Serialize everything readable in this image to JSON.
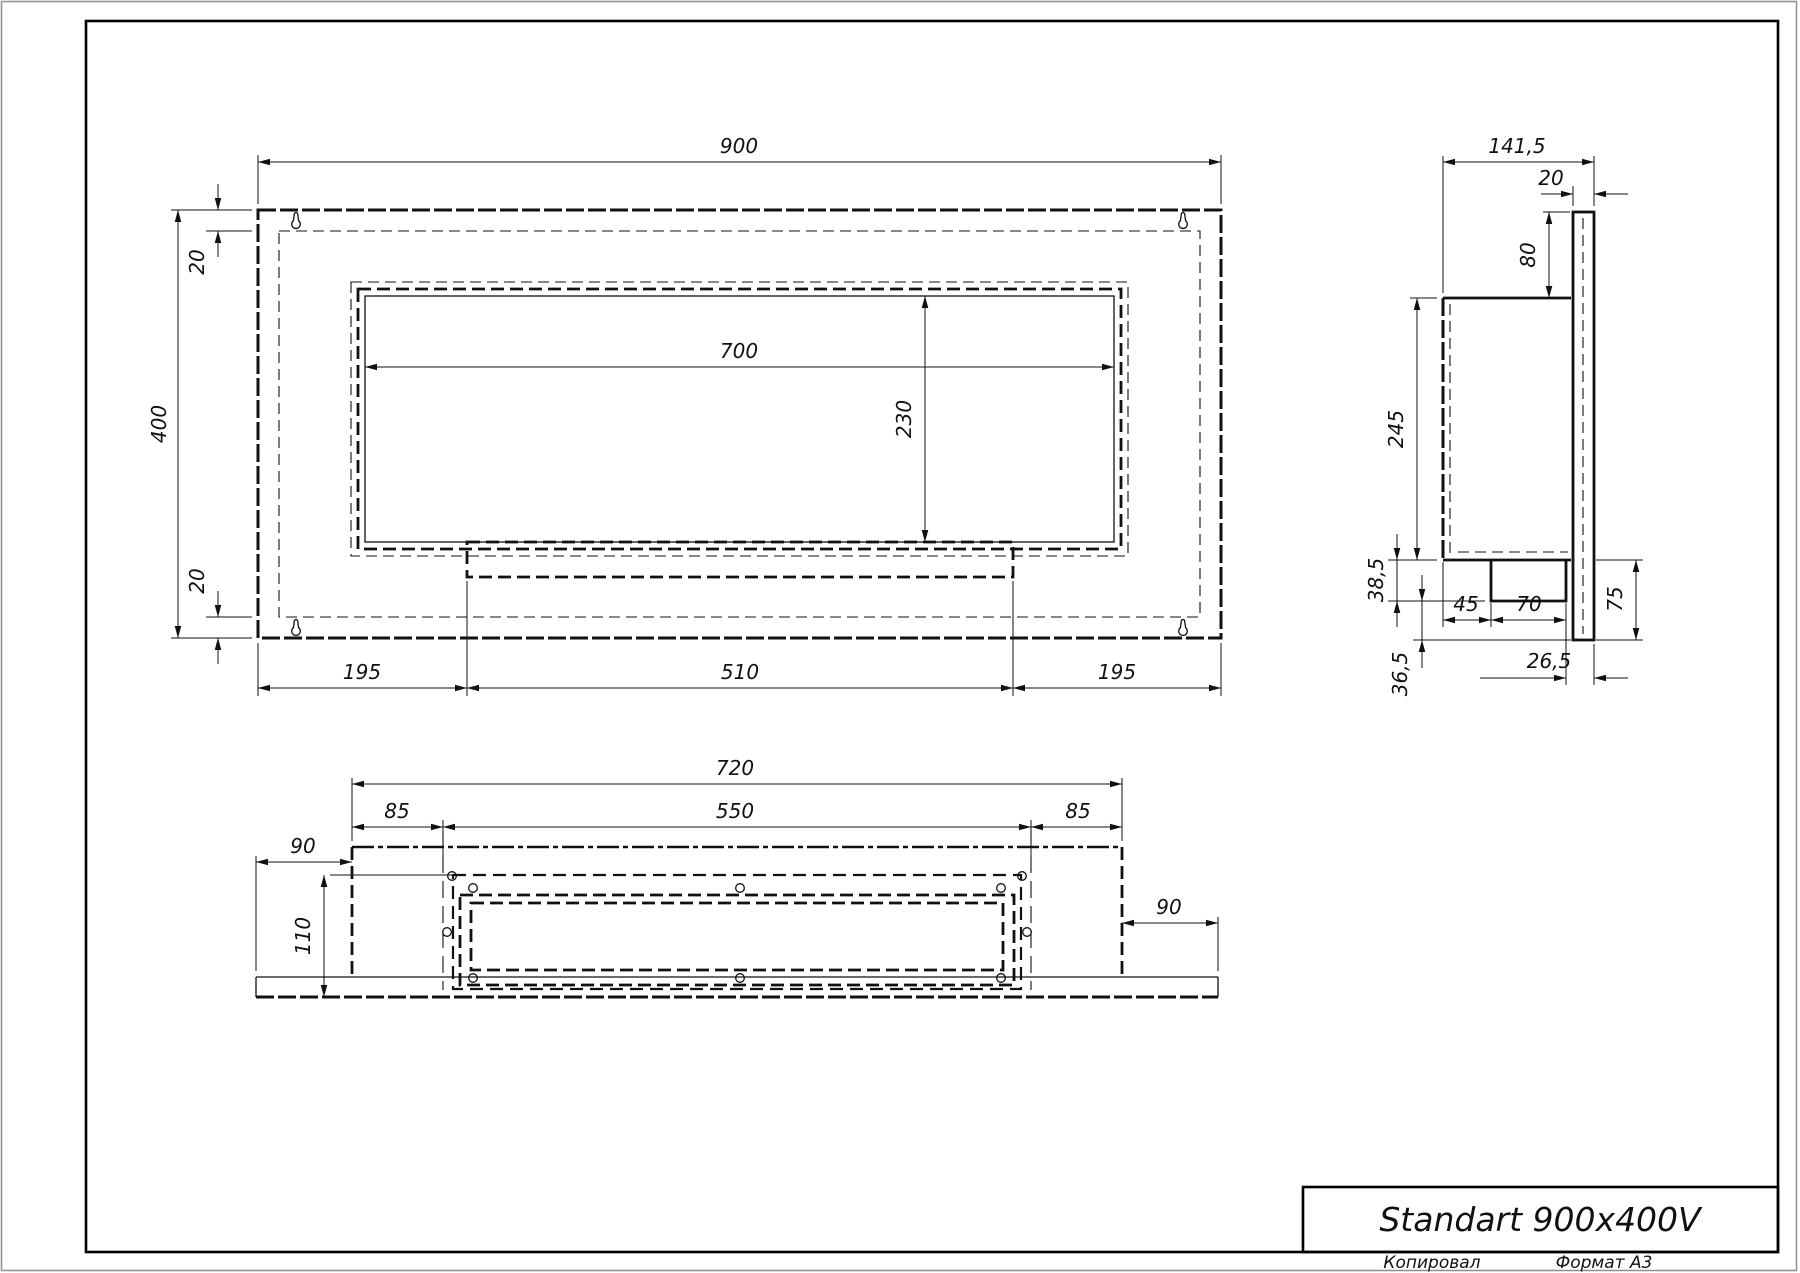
{
  "sheet": {
    "title": "Standart 900x400V",
    "copied_label": "Копировал",
    "format_label": "Формат А3"
  },
  "front": {
    "width": "900",
    "height": "400",
    "top_inset": "20",
    "bottom_inset": "20",
    "opening_width": "700",
    "opening_height": "230",
    "left_margin": "195",
    "center_width": "510",
    "right_margin": "195"
  },
  "side": {
    "total_depth": "141,5",
    "wall_thickness": "20",
    "top_offset": "80",
    "body_height": "245",
    "box_height": "38,5",
    "box_bottom_offset": "36,5",
    "box_front_offset": "45",
    "box_width": "70",
    "box_back_offset": "26,5",
    "lower_height": "75"
  },
  "bottom": {
    "body_width": "720",
    "inner_width": "550",
    "left_inset": "85",
    "right_inset": "85",
    "left_overhang": "90",
    "right_overhang": "90",
    "depth": "110"
  }
}
